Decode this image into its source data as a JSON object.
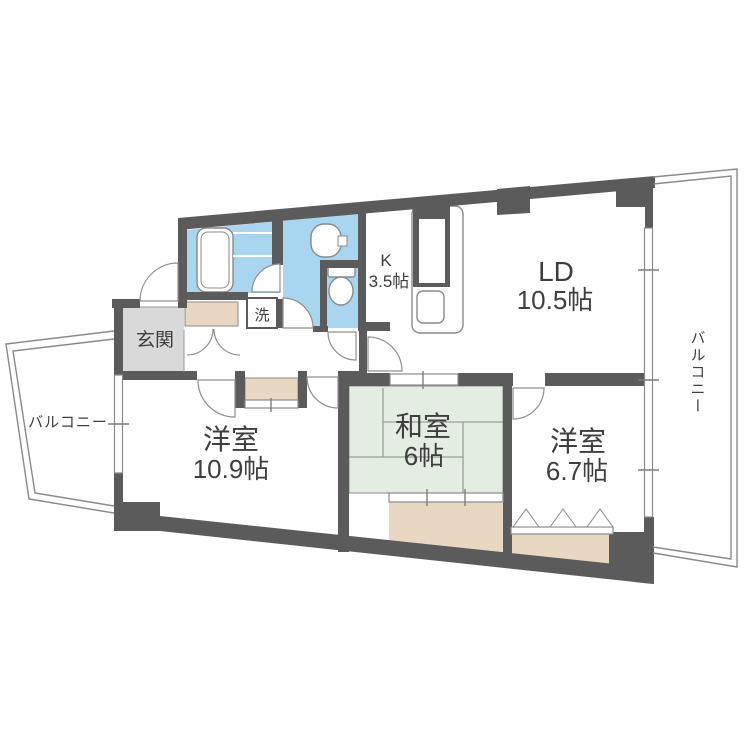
{
  "labels": {
    "entrance": "玄関",
    "laundry": "洗",
    "kitchen_name": "K",
    "kitchen_size": "3.5帖",
    "ld_name": "LD",
    "ld_size": "10.5帖",
    "western1_name": "洋室",
    "western1_size": "10.9帖",
    "japanese_name": "和室",
    "japanese_size": "6帖",
    "western2_name": "洋室",
    "western2_size": "6.7帖",
    "balcony_left": "バルコニー",
    "balcony_right": "バルコニー"
  },
  "colors": {
    "wall": "#5b5b5b",
    "water_blue": "#a8d6f0",
    "tatami_green": "#e4ede1",
    "closet_beige": "#ead7c1",
    "entrance_gray": "#d9d9d9",
    "outline_gray": "#8a8a8a",
    "text": "#3e3e3e"
  }
}
